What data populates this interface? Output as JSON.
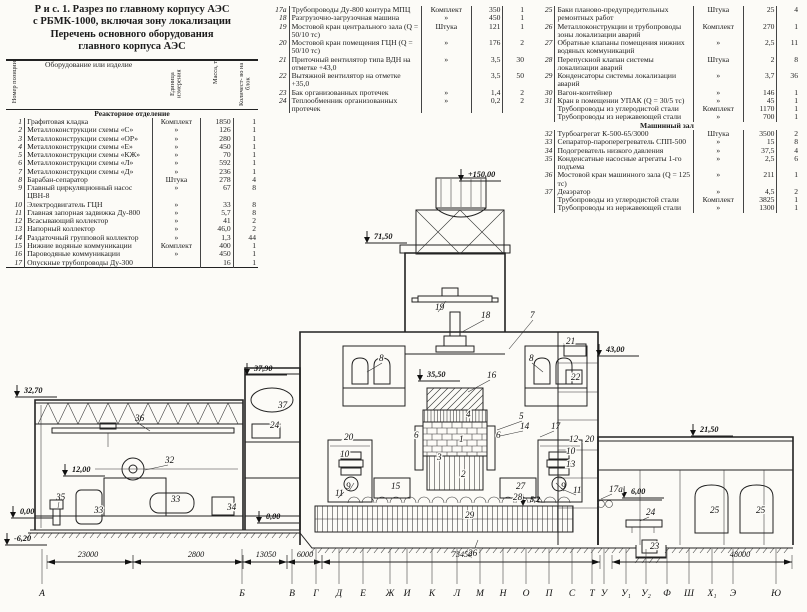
{
  "title": {
    "line1": "Р и с.  1.  Разрез по главному корпусу АЭС",
    "line2": "с РБМК-1000, включая зону локализации",
    "line3": "Перечень основного оборудования",
    "line4": "главного корпуса АЭС"
  },
  "table": {
    "headers": {
      "num": "Номер позиции",
      "name": "Оборудование или изделие",
      "unit": "Единица измерения",
      "mass": "Масса, т",
      "qty": "Количест- во на блок"
    },
    "col1": [
      {
        "section": "Реакторное отделение"
      },
      {
        "num": "1",
        "name": "Графитовая кладка",
        "unit": "Комплект",
        "mass": "1850",
        "qty": "1"
      },
      {
        "num": "2",
        "name": "Металлоконструкции схемы «С»",
        "unit": "»",
        "mass": "126",
        "qty": "1"
      },
      {
        "num": "3",
        "name": "Металлоконструкции схемы «ОР»",
        "unit": "»",
        "mass": "280",
        "qty": "1"
      },
      {
        "num": "4",
        "name": "Металлоконструкции схемы «Е»",
        "unit": "»",
        "mass": "450",
        "qty": "1"
      },
      {
        "num": "5",
        "name": "Металлоконструкции схемы «КЖ»",
        "unit": "»",
        "mass": "70",
        "qty": "1"
      },
      {
        "num": "6",
        "name": "Металлоконструкции схемы «Л»",
        "unit": "»",
        "mass": "592",
        "qty": "1"
      },
      {
        "num": "7",
        "name": "Металлоконструкции схемы «Д»",
        "unit": "»",
        "mass": "236",
        "qty": "1"
      },
      {
        "num": "8",
        "name": "Барабан-сепаратор",
        "unit": "Штука",
        "mass": "278",
        "qty": "4"
      },
      {
        "num": "9",
        "name": "Главный циркуляционный насос ЦВН-8",
        "unit": "»",
        "mass": "67",
        "qty": "8"
      },
      {
        "num": "10",
        "name": "Электродвигатель ГЦН",
        "unit": "»",
        "mass": "33",
        "qty": "8"
      },
      {
        "num": "11",
        "name": "Главная запорная задвижка Ду-800",
        "unit": "»",
        "mass": "5,7",
        "qty": "8"
      },
      {
        "num": "12",
        "name": "Всасывающий коллектор",
        "unit": "»",
        "mass": "41",
        "qty": "2"
      },
      {
        "num": "13",
        "name": "Напорный коллектор",
        "unit": "»",
        "mass": "46,0",
        "qty": "2"
      },
      {
        "num": "14",
        "name": "Раздаточный групповой коллектор",
        "unit": "»",
        "mass": "1,3",
        "qty": "44"
      },
      {
        "num": "15",
        "name": "Нижние водяные коммуникации",
        "unit": "Комплект",
        "mass": "400",
        "qty": "1"
      },
      {
        "num": "16",
        "name": "Пароводяные коммуникации",
        "unit": "»",
        "mass": "450",
        "qty": "1"
      },
      {
        "num": "17",
        "name": "Опускные трубопроводы Ду-300",
        "unit": "",
        "mass": "16",
        "qty": "1"
      }
    ],
    "col2": [
      {
        "num": "17а",
        "name": "Трубопроводы Ду-800 контура МПЦ",
        "unit": "Комплект",
        "mass": "350",
        "qty": "1"
      },
      {
        "num": "18",
        "name": "Разгрузочно-загрузочная машина",
        "unit": "»",
        "mass": "450",
        "qty": "1"
      },
      {
        "num": "19",
        "name": "Мостовой кран центрального зала (Q = 50/10 тс)",
        "unit": "Штука",
        "mass": "121",
        "qty": "1"
      },
      {
        "num": "20",
        "name": "Мостовой кран помещения ГЦН (Q = 50/10 тс)",
        "unit": "»",
        "mass": "176",
        "qty": "2"
      },
      {
        "num": "21",
        "name": "Приточный вентилятор типа ВДН на отметке +43,0",
        "unit": "»",
        "mass": "3,5",
        "qty": "30"
      },
      {
        "num": "22",
        "name": "Вытяжной вентилятор на отметке +35,0",
        "unit": "",
        "mass": "3,5",
        "qty": "50"
      },
      {
        "num": "23",
        "name": "Бак организованных протечек",
        "unit": "»",
        "mass": "1,4",
        "qty": "2"
      },
      {
        "num": "24",
        "name": "Теплообменник организованных протечек",
        "unit": "»",
        "mass": "0,2",
        "qty": "2"
      }
    ],
    "col3": [
      {
        "num": "25",
        "name": "Баки планово-предупредительных ремонтных работ",
        "unit": "Штука",
        "mass": "25",
        "qty": "4"
      },
      {
        "num": "26",
        "name": "Металлоконструкции и трубопроводы зоны локализации аварий",
        "unit": "Комплект",
        "mass": "270",
        "qty": "1"
      },
      {
        "num": "27",
        "name": "Обратные клапаны помещения нижних водяных коммуникаций",
        "unit": "»",
        "mass": "2,5",
        "qty": "11"
      },
      {
        "num": "28",
        "name": "Перепускной клапан системы локализации аварий",
        "unit": "Штука",
        "mass": "2",
        "qty": "8"
      },
      {
        "num": "29",
        "name": "Конденсаторы системы локализации аварий",
        "unit": "»",
        "mass": "3,7",
        "qty": "36"
      },
      {
        "num": "30",
        "name": "Вагон-контейнер",
        "unit": "»",
        "mass": "146",
        "qty": "1"
      },
      {
        "num": "31",
        "name": "Кран в помещении УПАК (Q = 30/5 тс)",
        "unit": "»",
        "mass": "45",
        "qty": "1"
      },
      {
        "num": "",
        "name": "Трубопроводы из углеродистой стали",
        "unit": "Комплект",
        "mass": "1170",
        "qty": "1"
      },
      {
        "num": "",
        "name": "Трубопроводы из нержавеющей стали",
        "unit": "»",
        "mass": "700",
        "qty": "1"
      },
      {
        "section": "Машинный зал"
      },
      {
        "num": "32",
        "name": "Турбоагрегат К-500-65/3000",
        "unit": "Штука",
        "mass": "3500",
        "qty": "2"
      },
      {
        "num": "33",
        "name": "Сепаратор-пароперегреватель СПП-500",
        "unit": "»",
        "mass": "15",
        "qty": "8"
      },
      {
        "num": "34",
        "name": "Подогреватель низкого давления",
        "unit": "»",
        "mass": "37,5",
        "qty": "4"
      },
      {
        "num": "35",
        "name": "Конденсатные насосные агрегаты 1-го подъема",
        "unit": "»",
        "mass": "2,5",
        "qty": "6"
      },
      {
        "num": "36",
        "name": "Мостовой кран машинного зала (Q = 125 тс)",
        "unit": "»",
        "mass": "211",
        "qty": "1"
      },
      {
        "num": "37",
        "name": "Деаэратор",
        "unit": "»",
        "mass": "4,5",
        "qty": "2"
      },
      {
        "num": "",
        "name": "Трубопроводы из углеродистой стали",
        "unit": "Комплект",
        "mass": "3825",
        "qty": "1"
      },
      {
        "num": "",
        "name": "Трубопроводы из нержавеющей стали",
        "unit": "»",
        "mass": "1300",
        "qty": "1"
      }
    ]
  },
  "drawing": {
    "elevations": [
      {
        "label": "+150,00",
        "x": 468,
        "y": 177
      },
      {
        "label": "71,50",
        "x": 374,
        "y": 239
      },
      {
        "label": "43,00",
        "x": 606,
        "y": 352
      },
      {
        "label": "37,90",
        "x": 254,
        "y": 371
      },
      {
        "label": "35,50",
        "x": 427,
        "y": 377
      },
      {
        "label": "32,70",
        "x": 24,
        "y": 393
      },
      {
        "label": "21,50",
        "x": 700,
        "y": 432
      },
      {
        "label": "12,00",
        "x": 72,
        "y": 472
      },
      {
        "label": "6,00",
        "x": 631,
        "y": 494
      },
      {
        "label": "0,00",
        "x": 20,
        "y": 514
      },
      {
        "label": "0,00",
        "x": 266,
        "y": 519
      },
      {
        "label": "5,2",
        "x": 530,
        "y": 502
      },
      {
        "label": "-6,20",
        "x": 14,
        "y": 541
      }
    ],
    "callouts": [
      {
        "label": "1",
        "x": 459,
        "y": 442,
        "halo": true
      },
      {
        "label": "2",
        "x": 461,
        "y": 477,
        "halo": true
      },
      {
        "label": "3",
        "x": 437,
        "y": 460,
        "halo": true
      },
      {
        "label": "4",
        "x": 466,
        "y": 417,
        "halo": true
      },
      {
        "label": "5",
        "x": 519,
        "y": 419,
        "l": [
          497,
          430
        ]
      },
      {
        "label": "6",
        "x": 414,
        "y": 438,
        "halo": true
      },
      {
        "label": "6",
        "x": 496,
        "y": 438,
        "halo": true
      },
      {
        "label": "7",
        "x": 530,
        "y": 318,
        "l": [
          509,
          349
        ]
      },
      {
        "label": "8",
        "x": 379,
        "y": 361,
        "halo": true,
        "l": [
          367,
          372
        ]
      },
      {
        "label": "8",
        "x": 529,
        "y": 361,
        "halo": true,
        "l": [
          543,
          372
        ]
      },
      {
        "label": "9",
        "x": 346,
        "y": 489,
        "l": [
          354,
          483
        ]
      },
      {
        "label": "9",
        "x": 561,
        "y": 489,
        "l": [
          556,
          483
        ]
      },
      {
        "label": "10",
        "x": 340,
        "y": 457,
        "halo": true
      },
      {
        "label": "10",
        "x": 566,
        "y": 454,
        "halo": true
      },
      {
        "label": "11",
        "x": 335,
        "y": 496,
        "l": [
          344,
          492
        ]
      },
      {
        "label": "11",
        "x": 573,
        "y": 493,
        "l": [
          564,
          490
        ]
      },
      {
        "label": "12",
        "x": 569,
        "y": 442,
        "halo": true
      },
      {
        "label": "13",
        "x": 566,
        "y": 467,
        "halo": true
      },
      {
        "label": "14",
        "x": 520,
        "y": 429,
        "l": [
          500,
          436
        ]
      },
      {
        "label": "15",
        "x": 391,
        "y": 489,
        "halo": true
      },
      {
        "label": "16",
        "x": 487,
        "y": 378,
        "l": [
          468,
          392
        ]
      },
      {
        "label": "17",
        "x": 551,
        "y": 429,
        "l": [
          540,
          437
        ]
      },
      {
        "label": "17а",
        "x": 609,
        "y": 492,
        "halo": true,
        "l": [
          601,
          499
        ]
      },
      {
        "label": "18",
        "x": 481,
        "y": 318,
        "l": [
          462,
          332
        ]
      },
      {
        "label": "19",
        "x": 435,
        "y": 310,
        "l": [
          446,
          301
        ]
      },
      {
        "label": "20",
        "x": 344,
        "y": 440,
        "halo": true
      },
      {
        "label": "20",
        "x": 585,
        "y": 442,
        "halo": true
      },
      {
        "label": "21",
        "x": 566,
        "y": 344,
        "halo": true
      },
      {
        "label": "22",
        "x": 571,
        "y": 380,
        "halo": true
      },
      {
        "label": "23",
        "x": 650,
        "y": 549,
        "halo": true
      },
      {
        "label": "24",
        "x": 270,
        "y": 428,
        "halo": true
      },
      {
        "label": "24",
        "x": 646,
        "y": 515,
        "l": [
          640,
          521
        ]
      },
      {
        "label": "25",
        "x": 710,
        "y": 513,
        "halo": true
      },
      {
        "label": "25",
        "x": 756,
        "y": 513,
        "halo": true
      },
      {
        "label": "26",
        "x": 468,
        "y": 556,
        "halo": true,
        "l": [
          478,
          540
        ]
      },
      {
        "label": "27",
        "x": 516,
        "y": 489,
        "halo": true
      },
      {
        "label": "28",
        "x": 513,
        "y": 500,
        "halo": true
      },
      {
        "label": "29",
        "x": 465,
        "y": 518,
        "halo": true
      },
      {
        "label": "32",
        "x": 165,
        "y": 463,
        "l": [
          145,
          470
        ]
      },
      {
        "label": "33",
        "x": 94,
        "y": 513,
        "halo": true
      },
      {
        "label": "33",
        "x": 171,
        "y": 502,
        "halo": true
      },
      {
        "label": "34",
        "x": 227,
        "y": 510,
        "halo": true
      },
      {
        "label": "35",
        "x": 56,
        "y": 500,
        "l": [
          58,
          508
        ]
      },
      {
        "label": "36",
        "x": 135,
        "y": 421,
        "l": [
          150,
          431
        ]
      },
      {
        "label": "37",
        "x": 278,
        "y": 408,
        "halo": true
      }
    ],
    "dims": [
      {
        "label": "23000",
        "x1": 47,
        "x2": 133,
        "lx": 88
      },
      {
        "label": "2800",
        "x1": 133,
        "x2": 243,
        "lx": 196
      },
      {
        "label": "13050",
        "x1": 243,
        "x2": 287,
        "lx": 266
      },
      {
        "label": "6000",
        "x1": 287,
        "x2": 322,
        "lx": 305
      },
      {
        "label": "73450",
        "x1": 322,
        "x2": 600,
        "lx": 462
      },
      {
        "label": "48000",
        "x1": 612,
        "x2": 792,
        "lx": 740
      }
    ],
    "axes": [
      {
        "label": "А",
        "x": 42
      },
      {
        "label": "Б",
        "x": 242
      },
      {
        "label": "В",
        "x": 292
      },
      {
        "label": "Г",
        "x": 316
      },
      {
        "label": "Д",
        "x": 339
      },
      {
        "label": "Е",
        "x": 363
      },
      {
        "label": "Ж",
        "x": 390
      },
      {
        "label": "И",
        "x": 407
      },
      {
        "label": "К",
        "x": 432
      },
      {
        "label": "Л",
        "x": 457
      },
      {
        "label": "М",
        "x": 480
      },
      {
        "label": "Н",
        "x": 503
      },
      {
        "label": "О",
        "x": 526
      },
      {
        "label": "П",
        "x": 549
      },
      {
        "label": "С",
        "x": 572
      },
      {
        "label": "Т",
        "x": 592
      },
      {
        "label": "У",
        "x": 604
      },
      {
        "label": "У₁",
        "x": 626
      },
      {
        "label": "У₂",
        "x": 646
      },
      {
        "label": "Ф",
        "x": 667
      },
      {
        "label": "Ш",
        "x": 689
      },
      {
        "label": "Х₁",
        "x": 712
      },
      {
        "label": "Э",
        "x": 733
      },
      {
        "label": "Ю",
        "x": 776
      }
    ]
  }
}
